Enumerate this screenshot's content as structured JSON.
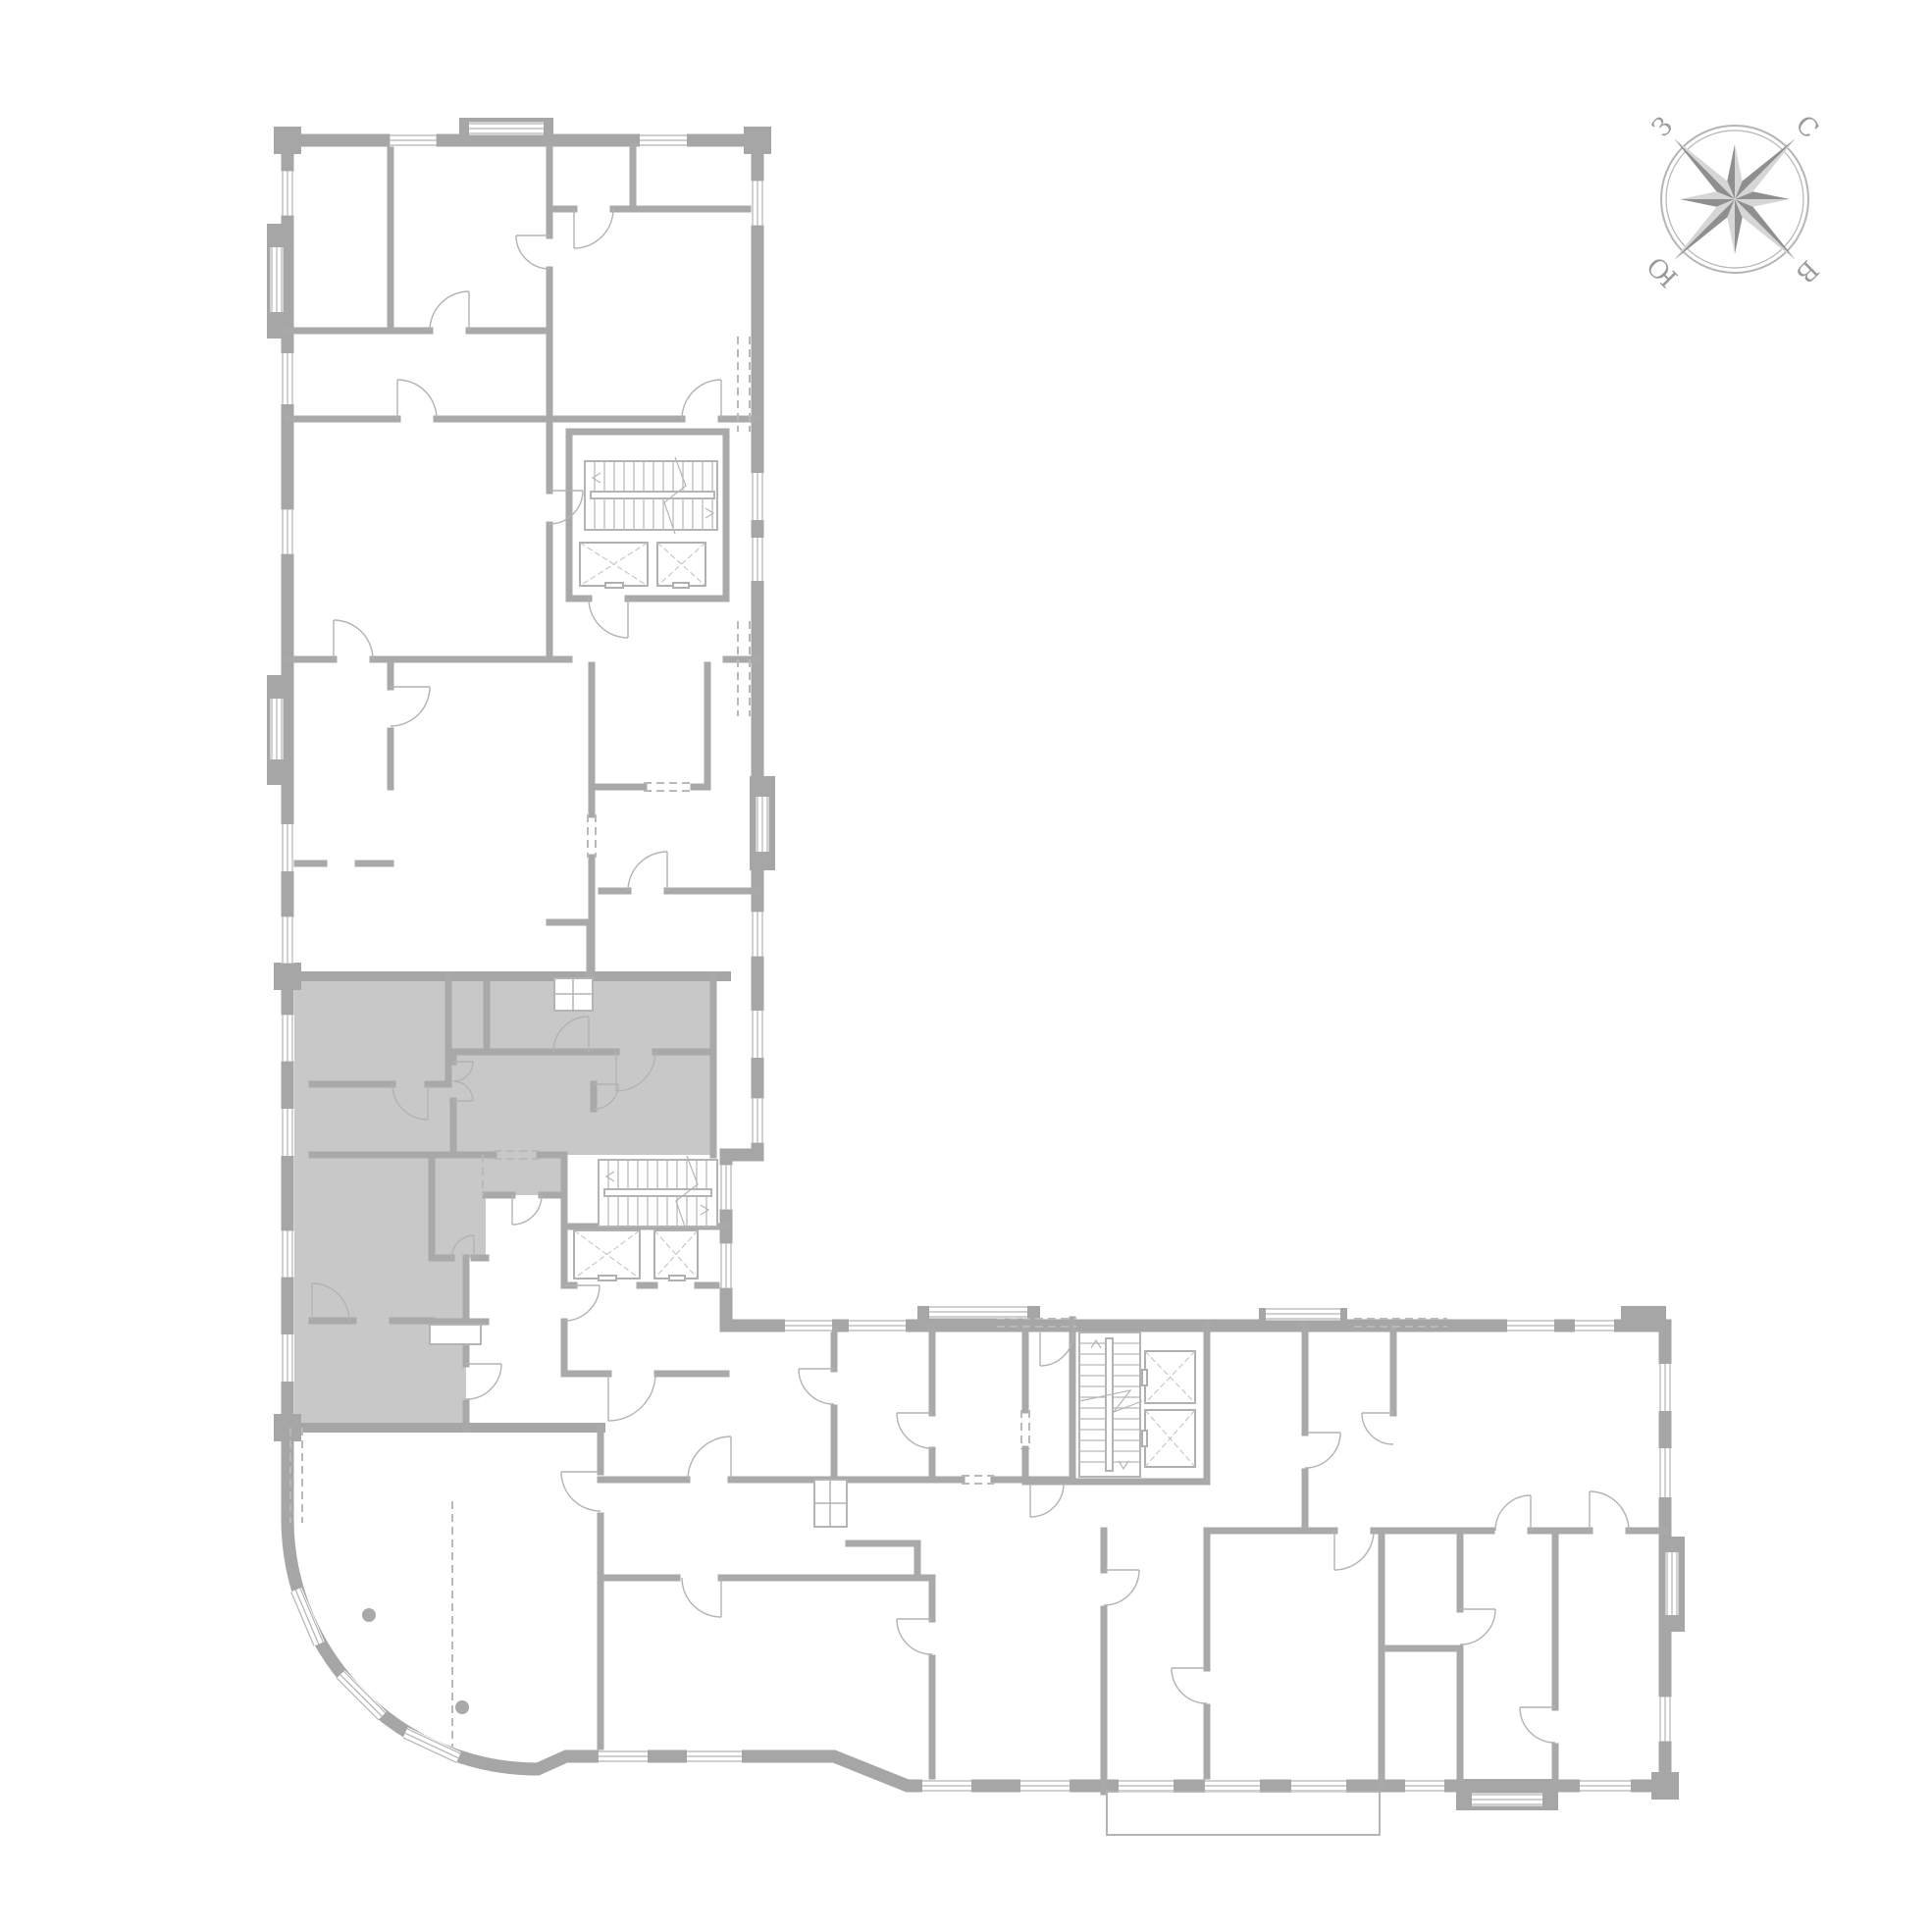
{
  "compass": {
    "labels": {
      "north": "С",
      "east": "В",
      "south": "Ю",
      "west": "З"
    }
  },
  "colors": {
    "background": "#ffffff",
    "exterior_walls": "#a6a6a6",
    "partitions": "#a9a9a9",
    "thin_lines": "#b4b4b4",
    "highlighted_apartment": "#c8c8c8",
    "compass_text": "#9a9a9a",
    "compass_dark": "#8f8f8f",
    "compass_light": "#d6d6d6"
  },
  "plan": {
    "highlighted_apartment": {
      "state": "selected"
    }
  }
}
